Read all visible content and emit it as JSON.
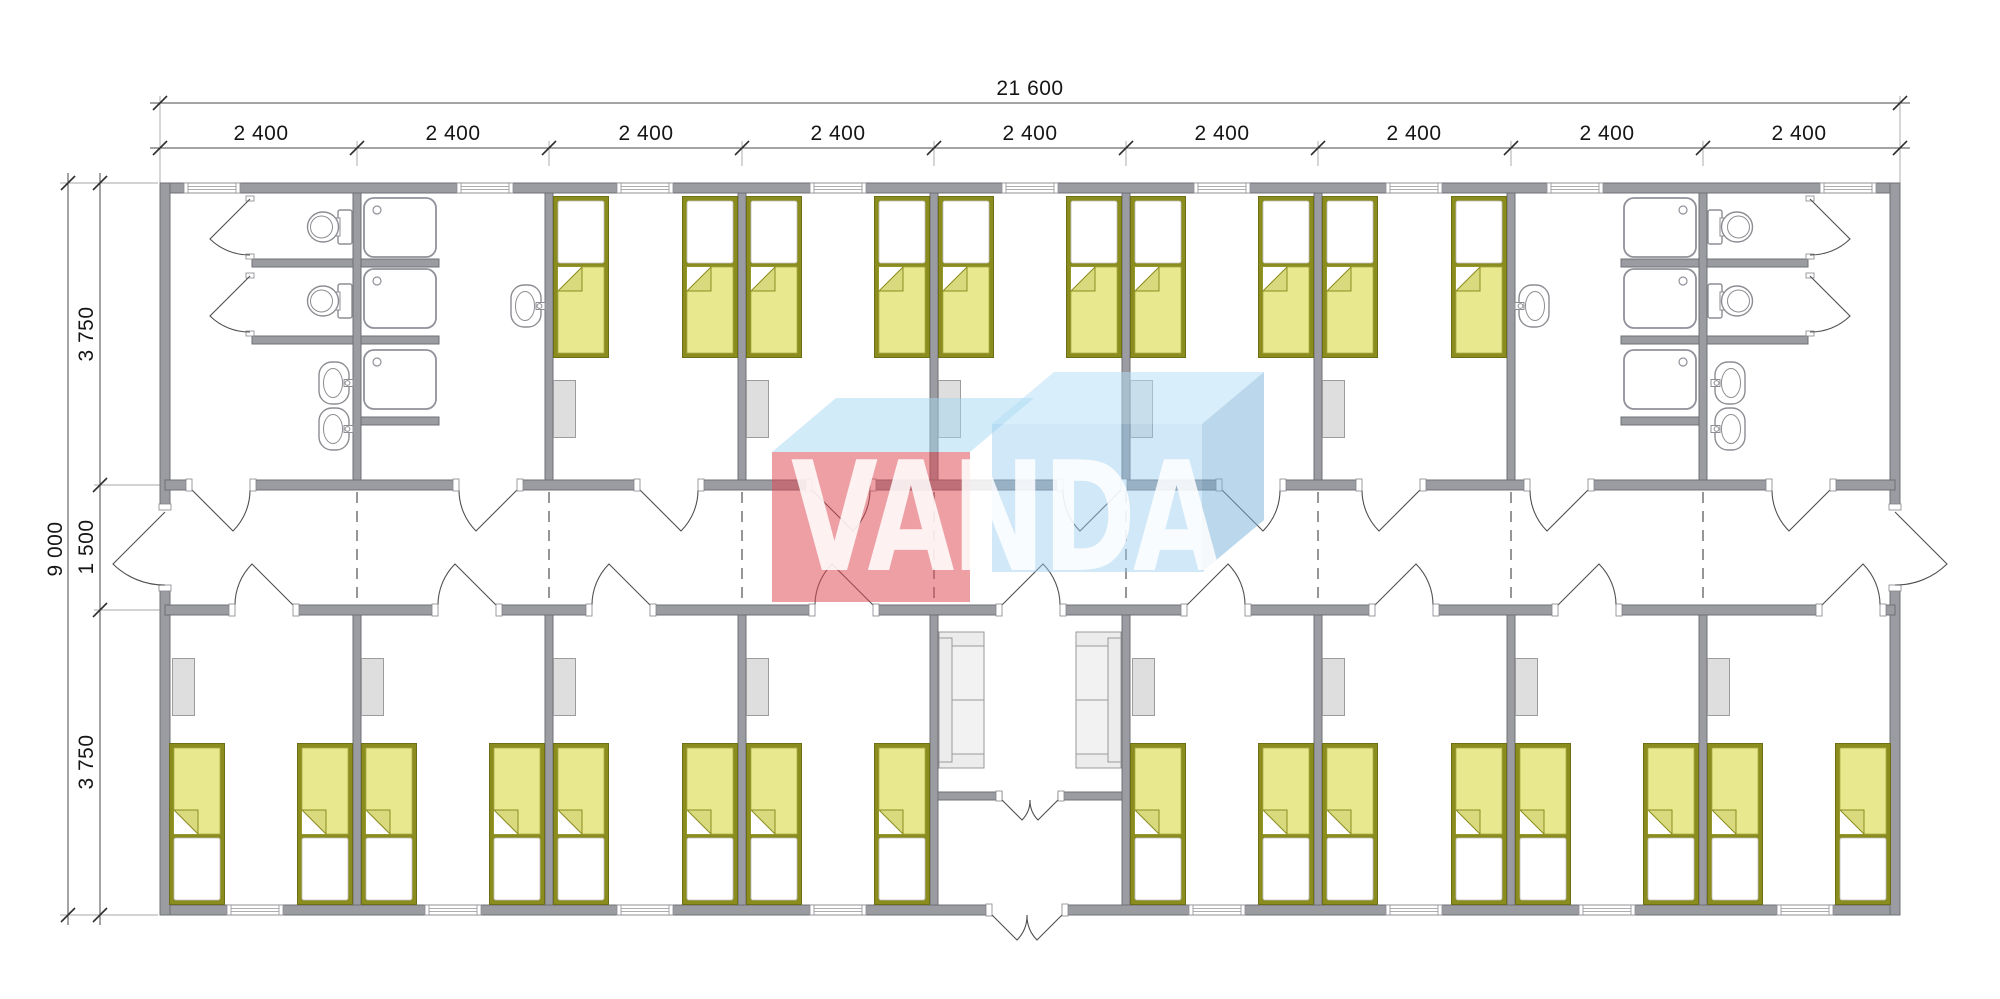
{
  "drawing": {
    "type": "modular-building-floor-plan",
    "units": "mm"
  },
  "dimension_labels": {
    "total_width": "21 600",
    "module_widths": [
      "2 400",
      "2 400",
      "2 400",
      "2 400",
      "2 400",
      "2 400",
      "2 400",
      "2 400",
      "2 400"
    ],
    "total_height": "9 000",
    "row_depths": [
      "3 750",
      "1 500",
      "3 750"
    ]
  },
  "logo": {
    "text": "VANDA",
    "red_block_color": "#df4650",
    "blue_block_color": "#9ccbea",
    "pale_blue_top_color": "#cfe8f8",
    "text_color": "#ffffff"
  },
  "colors": {
    "background": "#ffffff",
    "wall_fill": "#9b9ca2",
    "wall_stroke": "#6f7076",
    "bed_frame": "#8b8c1e",
    "bed_blanket": "#e8e88e",
    "bed_fold_flap": "#d9d97e",
    "pillow": "#ffffff",
    "furniture_fill": "#dedede",
    "fixture_stroke": "#8c8d92",
    "module_joint_dash": "#6a6a6a",
    "dimension_text": "#161616"
  },
  "plan_inventory": {
    "icons": [
      "bed",
      "wardrobe",
      "shower-stall",
      "toilet",
      "wash-basin",
      "sofa",
      "door-swing",
      "window",
      "module-joint-line"
    ],
    "beds_top_row": 10,
    "beds_bottom_row": 16,
    "shower_stalls": 6,
    "toilets": 4,
    "wash_basins": 6,
    "sofas": 2,
    "wardrobes": 13,
    "bedrooms": 13,
    "bathrooms": 2,
    "entrance_lobby": 1,
    "corridor": 1
  }
}
